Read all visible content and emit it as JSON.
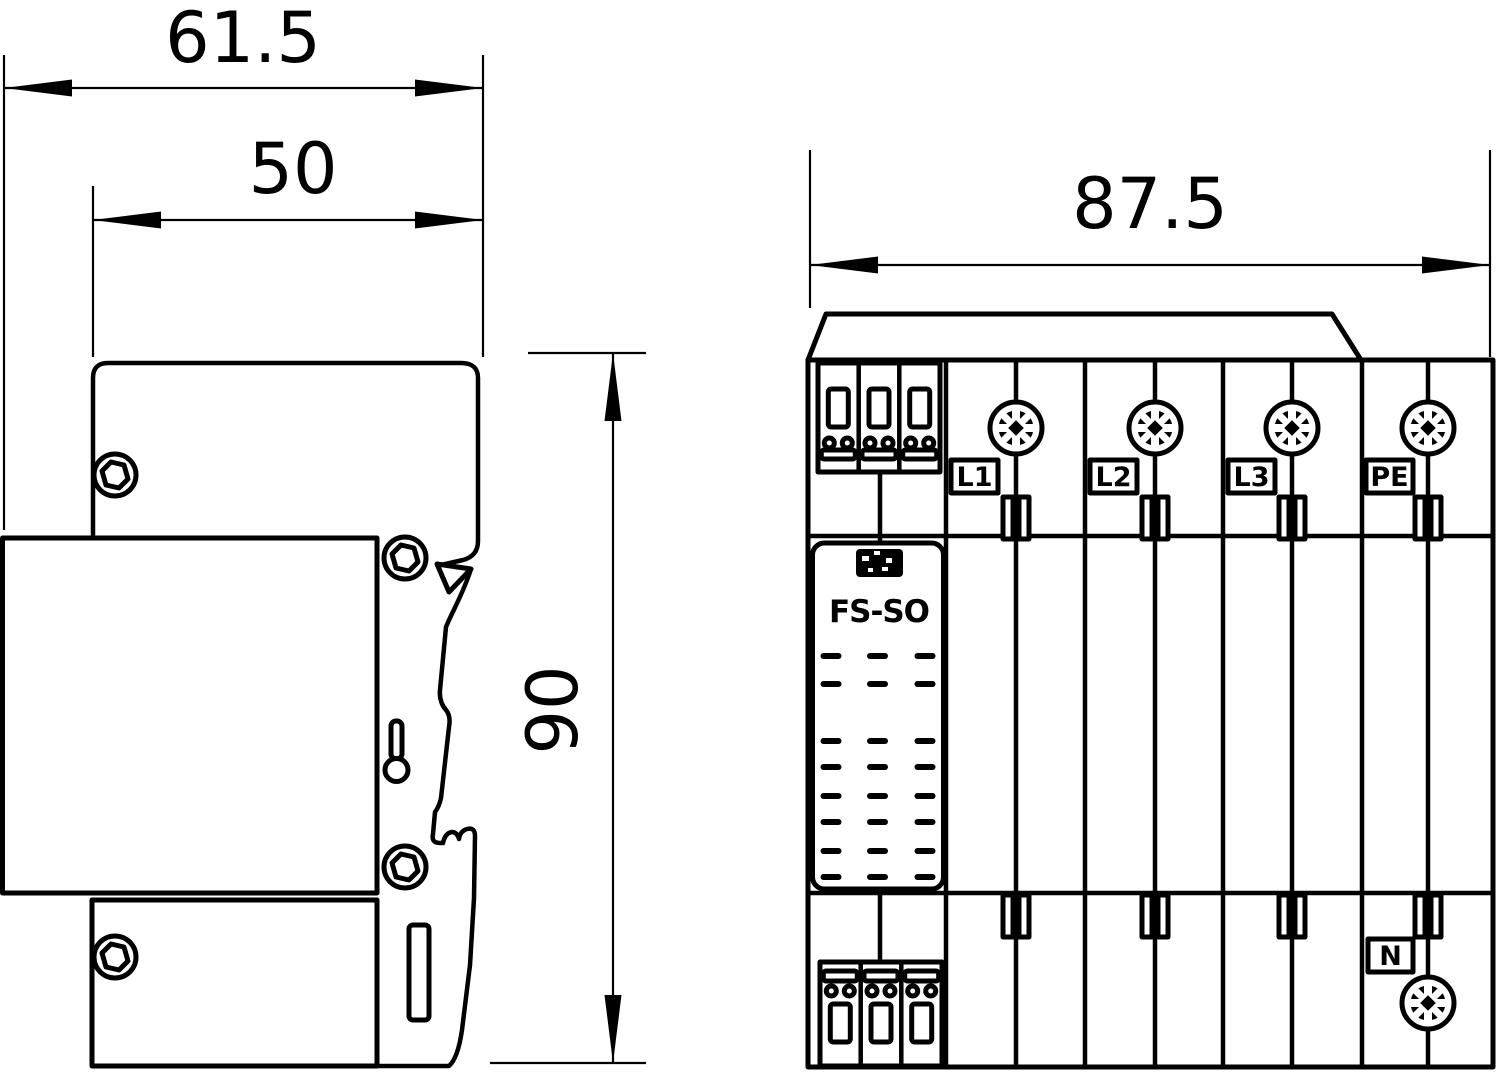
{
  "drawing": {
    "background": "#ffffff",
    "line_color": "#000000",
    "left_view": "side-profile-with-din-rail-clip",
    "right_view": "front-face-with-terminals"
  },
  "dimensions": {
    "side_outer_width": "61.5",
    "side_inner_width": "50",
    "front_width": "87.5",
    "side_height": "90"
  },
  "front_view": {
    "product_label": "FS-SO",
    "logo_icon": "brand-logo",
    "terminals": {
      "l1": "L1",
      "l2": "L2",
      "l3": "L3",
      "pe": "PE",
      "n": "N"
    }
  }
}
